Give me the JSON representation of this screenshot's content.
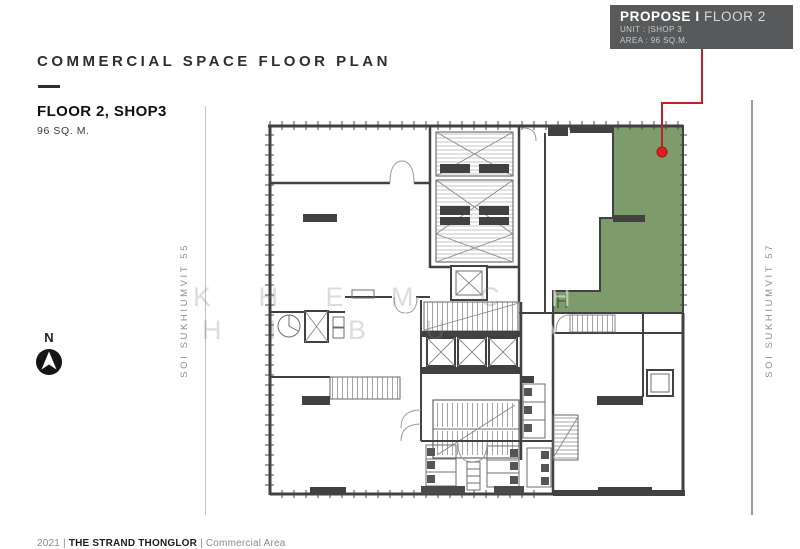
{
  "header": {
    "title": "COMMERCIAL SPACE FLOOR PLAN",
    "floor_label": "FLOOR 2, SHOP3",
    "area_label": "96 SQ. M."
  },
  "badge": {
    "title_bold": "PROPOSE I",
    "title_light": "FLOOR 2",
    "unit_line": "UNIT : |SHOP 3",
    "area_line": "AREA : 96 SQ.M.",
    "bg_color": "#58595b"
  },
  "streets": {
    "left": "SOI SUKHIUMVIT 55",
    "right": "SOI SUKHIUMVIT 57"
  },
  "compass": {
    "label": "N"
  },
  "watermark": {
    "l1a": "K H E M",
    "l1b": "C",
    "l1c": "H",
    "l2a": "H I",
    "l2b": "B U",
    "l2c": "A"
  },
  "footer": {
    "year": "2021",
    "separator": "|",
    "project": "THE STRAND THONGLOR",
    "section": "Commercial Area"
  },
  "colors": {
    "highlight_green": "#7e9c6b",
    "callout_red": "#c22127",
    "dot_red": "#d92020",
    "wall": "#414141",
    "badge_bg": "#58595b"
  }
}
